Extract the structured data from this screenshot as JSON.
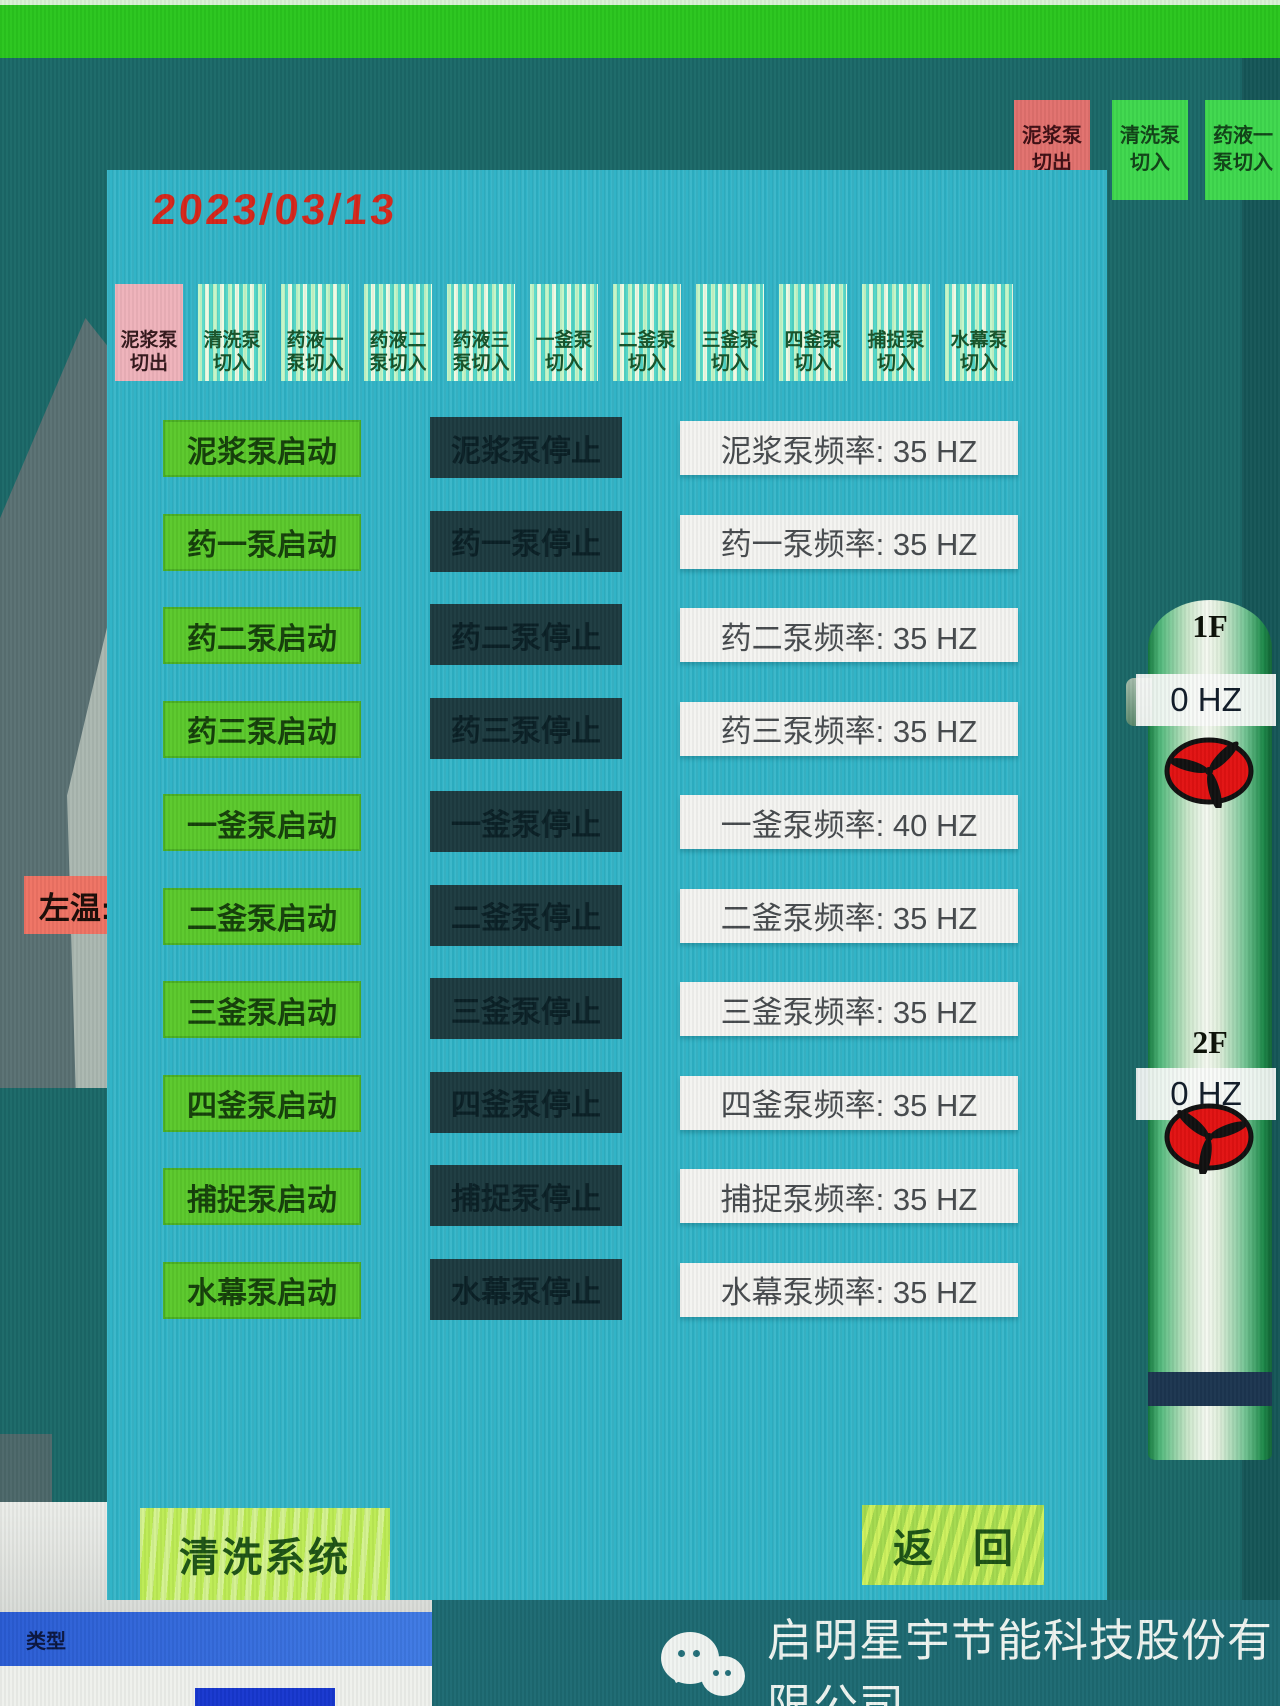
{
  "date": "2023/03/13",
  "corner_buttons": [
    {
      "key": "mud-pump-cutout",
      "line1": "泥浆泵",
      "line2": "切出"
    },
    {
      "key": "wash-pump-cutin",
      "line1": "清洗泵",
      "line2": "切入"
    },
    {
      "key": "chem1-pump-cutin",
      "line1": "药液一",
      "line2": "泵切入"
    }
  ],
  "tabs": [
    {
      "key": "mud-pump-cutout",
      "line1": "泥浆泵",
      "line2": "切出",
      "active": true
    },
    {
      "key": "wash-pump-cutin",
      "line1": "清洗泵",
      "line2": "切入",
      "active": false
    },
    {
      "key": "chem1-pump-cutin",
      "line1": "药液一",
      "line2": "泵切入",
      "active": false
    },
    {
      "key": "chem2-pump-cutin",
      "line1": "药液二",
      "line2": "泵切入",
      "active": false
    },
    {
      "key": "chem3-pump-cutin",
      "line1": "药液三",
      "line2": "泵切入",
      "active": false
    },
    {
      "key": "kettle1-pump-cutin",
      "line1": "一釜泵",
      "line2": "切入",
      "active": false
    },
    {
      "key": "kettle2-pump-cutin",
      "line1": "二釜泵",
      "line2": "切入",
      "active": false
    },
    {
      "key": "kettle3-pump-cutin",
      "line1": "三釜泵",
      "line2": "切入",
      "active": false
    },
    {
      "key": "kettle4-pump-cutin",
      "line1": "四釜泵",
      "line2": "切入",
      "active": false
    },
    {
      "key": "capture-pump-cutin",
      "line1": "捕捉泵",
      "line2": "切入",
      "active": false
    },
    {
      "key": "water-curtain-pump-cutin",
      "line1": "水幕泵",
      "line2": "切入",
      "active": false
    }
  ],
  "pump_rows": [
    {
      "key": "mud-pump",
      "start_label": "泥浆泵启动",
      "stop_label": "泥浆泵停止",
      "freq_label": "泥浆泵频率: 35 HZ",
      "freq_value": 35,
      "freq_unit": "HZ"
    },
    {
      "key": "chem1-pump",
      "start_label": "药一泵启动",
      "stop_label": "药一泵停止",
      "freq_label": "药一泵频率: 35 HZ",
      "freq_value": 35,
      "freq_unit": "HZ"
    },
    {
      "key": "chem2-pump",
      "start_label": "药二泵启动",
      "stop_label": "药二泵停止",
      "freq_label": "药二泵频率: 35 HZ",
      "freq_value": 35,
      "freq_unit": "HZ"
    },
    {
      "key": "chem3-pump",
      "start_label": "药三泵启动",
      "stop_label": "药三泵停止",
      "freq_label": "药三泵频率: 35 HZ",
      "freq_value": 35,
      "freq_unit": "HZ"
    },
    {
      "key": "kettle1-pump",
      "start_label": "一釜泵启动",
      "stop_label": "一釜泵停止",
      "freq_label": "一釜泵频率: 40 HZ",
      "freq_value": 40,
      "freq_unit": "HZ"
    },
    {
      "key": "kettle2-pump",
      "start_label": "二釜泵启动",
      "stop_label": "二釜泵停止",
      "freq_label": "二釜泵频率: 35 HZ",
      "freq_value": 35,
      "freq_unit": "HZ"
    },
    {
      "key": "kettle3-pump",
      "start_label": "三釜泵启动",
      "stop_label": "三釜泵停止",
      "freq_label": "三釜泵频率: 35 HZ",
      "freq_value": 35,
      "freq_unit": "HZ"
    },
    {
      "key": "kettle4-pump",
      "start_label": "四釜泵启动",
      "stop_label": "四釜泵停止",
      "freq_label": "四釜泵频率: 35 HZ",
      "freq_value": 35,
      "freq_unit": "HZ"
    },
    {
      "key": "capture-pump",
      "start_label": "捕捉泵启动",
      "stop_label": "捕捉泵停止",
      "freq_label": "捕捉泵频率: 35 HZ",
      "freq_value": 35,
      "freq_unit": "HZ"
    },
    {
      "key": "water-curtain-pump",
      "start_label": "水幕泵启动",
      "stop_label": "水幕泵停止",
      "freq_label": "水幕泵频率: 35 HZ",
      "freq_value": 35,
      "freq_unit": "HZ"
    }
  ],
  "bottom": {
    "clean_system_label": "清洗系统",
    "back_label": "返　回"
  },
  "vessel": {
    "sections": [
      {
        "label": "1F",
        "freq": "0 HZ"
      },
      {
        "label": "2F",
        "freq": "0 HZ"
      }
    ]
  },
  "left_area": {
    "temp_label": "左温:",
    "window_type_label": "类型"
  },
  "watermark": {
    "company": "启明星宇节能科技股份有限公司",
    "icon": "wechat-icon"
  },
  "colors": {
    "top_bar_green": "#2ac61e",
    "background_teal": "#1b6968",
    "panel_cyan": "#2eb3c6",
    "start_button_green": "#5bc92c",
    "stop_button_dark": "#1d3b40",
    "freq_box_white": "#f4f4f1",
    "active_tab_pink": "#efb3bb",
    "corner_alert_pink": "#e2716e",
    "corner_action_green": "#3fd84e",
    "bottom_button_yellow_green": "#bdec55",
    "date_red": "#d5271b",
    "fan_red": "#e21212",
    "temp_label_pink": "#ef7364"
  }
}
